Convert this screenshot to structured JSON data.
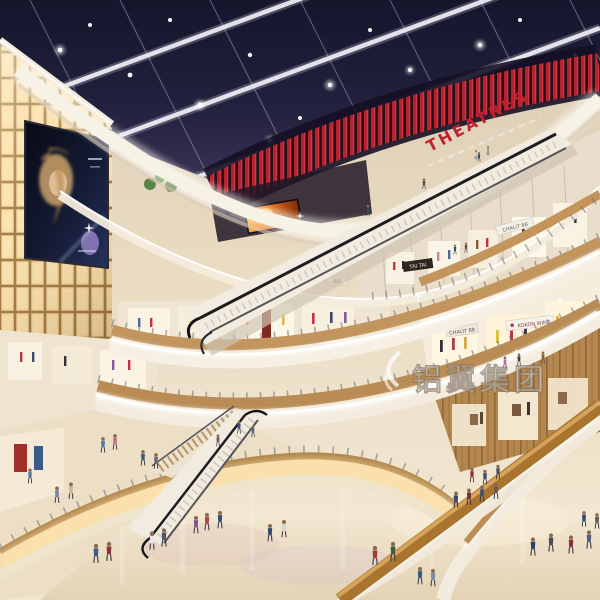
{
  "scene": {
    "kind": "shopping-mall-atrium-rendering",
    "signs": {
      "theatres": "THEATRES",
      "tai_tai": "TAI TAI",
      "chalit_88": "CHALIT 88",
      "kokon_wing": "KOKON WING",
      "aja": "AJA"
    },
    "watermark": {
      "text": "铝翼集团"
    },
    "palette": {
      "skylight_navy": "#1f1f3b",
      "beam_white": "#eceaf2",
      "theatre_red": "#bc2330",
      "glow_panel_amber": "#f6d69c",
      "wood_rail": "#b98c55",
      "fascia_white": "#f5efe3",
      "floor_beige": "#eee1c9",
      "led_screen_orange": "#e06a1a",
      "ad_night_blue": "#141a33"
    }
  }
}
